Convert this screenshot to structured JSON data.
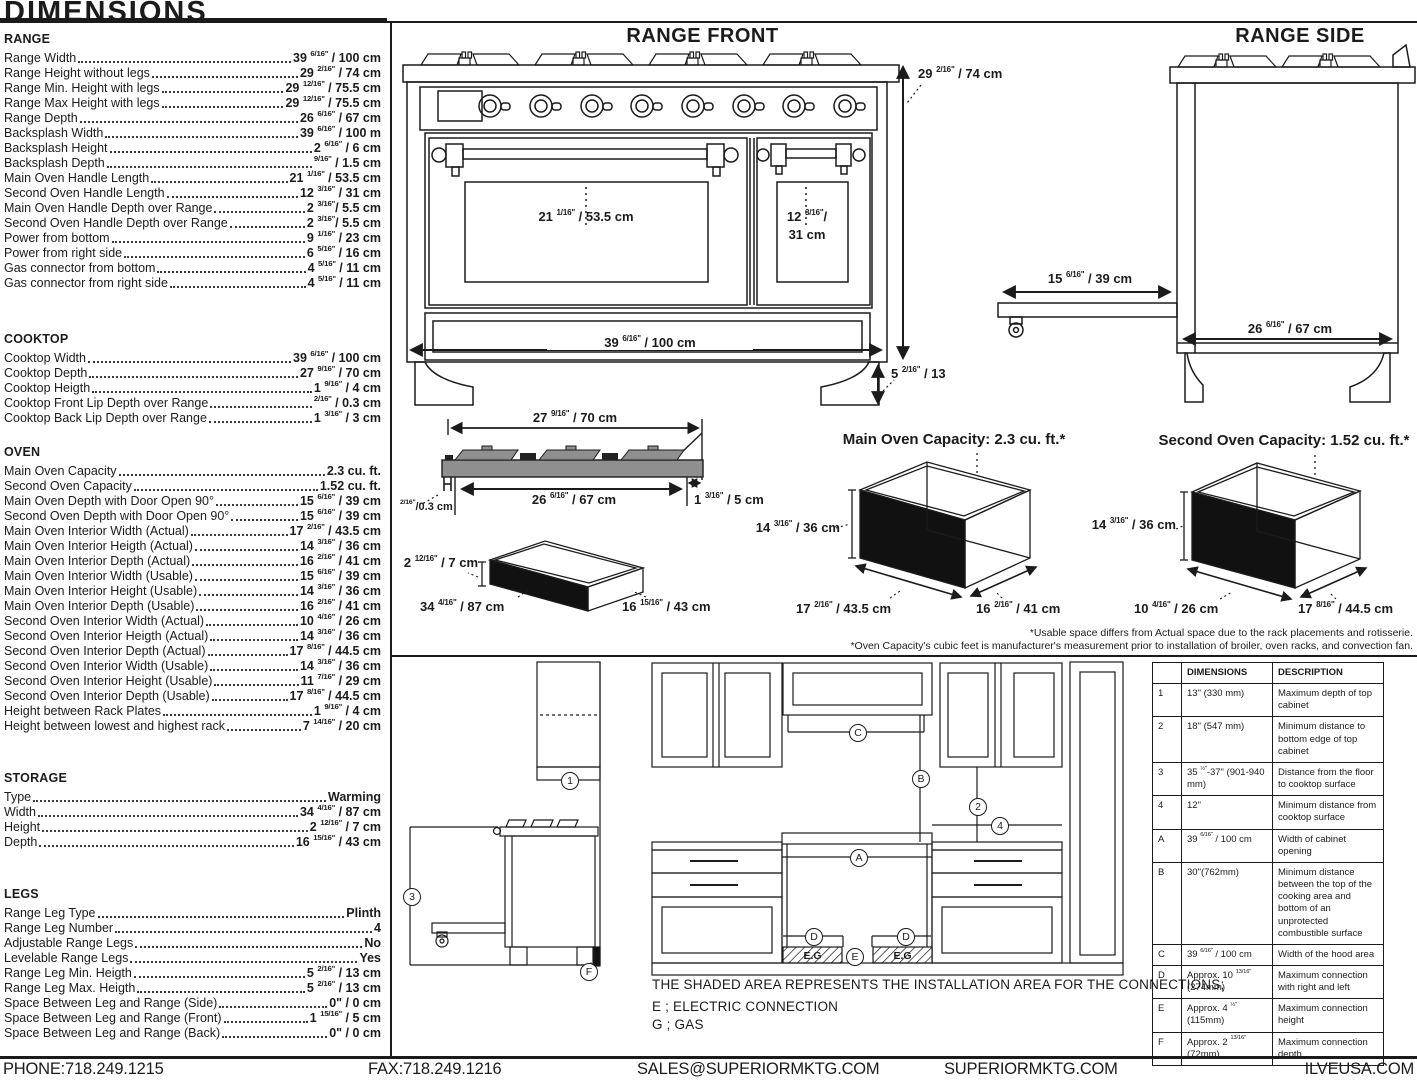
{
  "page": {
    "title": "DIMENSIONS",
    "footer": {
      "phone": "PHONE:718.249.1215",
      "fax": "FAX:718.249.1216",
      "email": "SALES@SUPERIORMKTG.COM",
      "website": "SUPERIORMKTG.COM",
      "brand_site": "ILVEUSA.COM"
    }
  },
  "specs": {
    "range": {
      "title": "RANGE",
      "rows": [
        {
          "label": "Range Width",
          "value": "39 6/16\" / 100 cm"
        },
        {
          "label": "Range Height without legs",
          "value": "29 2/16\" / 74 cm"
        },
        {
          "label": "Range Min. Height with legs",
          "value": "29 12/16\" / 75.5 cm"
        },
        {
          "label": "Range Max Height with legs",
          "value": "29 12/16\" / 75.5 cm"
        },
        {
          "label": "Range Depth",
          "value": "26 6/16\" / 67 cm"
        },
        {
          "label": "Backsplash Width",
          "value": "39 6/16\" / 100 m"
        },
        {
          "label": "Backsplash Height",
          "value": "2 6/16\" / 6 cm"
        },
        {
          "label": "Backsplash Depth",
          "value": "9/16\" / 1.5 cm"
        },
        {
          "label": "Main Oven Handle Length",
          "value": "21 1/16\" / 53.5 cm"
        },
        {
          "label": "Second Oven Handle Length",
          "value": "12 3/16\" / 31 cm"
        },
        {
          "label": "Main Oven Handle Depth over Range",
          "value": "2 3/16\"/ 5.5 cm"
        },
        {
          "label": "Second Oven Handle Depth over Range",
          "value": "2 3/16\"/ 5.5 cm"
        },
        {
          "label": "Power from bottom",
          "value": "9 1/16\" / 23 cm"
        },
        {
          "label": "Power from right side",
          "value": "6 5/16\" / 16 cm"
        },
        {
          "label": "Gas connector from bottom",
          "value": "4 5/16\" / 11 cm"
        },
        {
          "label": "Gas connector from right side",
          "value": "4 5/16\" / 11 cm"
        }
      ]
    },
    "cooktop": {
      "title": "COOKTOP",
      "rows": [
        {
          "label": "Cooktop Width",
          "value": "39 6/16\" / 100 cm"
        },
        {
          "label": "Cooktop Depth",
          "value": "27 9/16\" / 70 cm"
        },
        {
          "label": "Cooktop Heigth",
          "value": "1 9/16\" / 4 cm"
        },
        {
          "label": "Cooktop Front Lip Depth over Range",
          "value": "2/16\" / 0.3 cm"
        },
        {
          "label": "Cooktop Back Lip Depth over Range",
          "value": "1 3/16\" / 3 cm"
        }
      ]
    },
    "oven": {
      "title": "OVEN",
      "rows": [
        {
          "label": "Main Oven Capacity",
          "value": "2.3 cu. ft."
        },
        {
          "label": "Second Oven Capacity",
          "value": "1.52 cu. ft."
        },
        {
          "label": "Main Oven Depth with Door Open 90°",
          "value": "15 6/16\" / 39 cm"
        },
        {
          "label": "Second Oven Depth with Door Open 90°",
          "value": "15 6/16\" / 39 cm"
        },
        {
          "label": "Main Oven Interior Width (Actual)",
          "value": "17 2/16\" / 43.5 cm"
        },
        {
          "label": "Main Oven Interior Heigth (Actual)",
          "value": "14 3/16\" / 36 cm"
        },
        {
          "label": "Main Oven Interior Depth (Actual)",
          "value": "16 2/16\" / 41 cm"
        },
        {
          "label": "Main Oven Interior Width (Usable)",
          "value": "15 6/16\" / 39 cm"
        },
        {
          "label": "Main Oven Interior Height (Usable)",
          "value": "14 3/16\" / 36 cm"
        },
        {
          "label": "Main Oven Interior Depth (Usable)",
          "value": "16 2/16\" / 41 cm"
        },
        {
          "label": "Second Oven Interior Width (Actual)",
          "value": "10 4/16\" / 26 cm"
        },
        {
          "label": "Second Oven Interior Heigth (Actual)",
          "value": "14 3/16\" / 36 cm"
        },
        {
          "label": "Second Oven Interior Depth (Actual)",
          "value": "17 8/16\" / 44.5 cm"
        },
        {
          "label": "Second Oven Interior Width (Usable)",
          "value": "14 3/16\" / 36 cm"
        },
        {
          "label": "Second Oven Interior Height (Usable)",
          "value": "11 7/16\" / 29 cm"
        },
        {
          "label": "Second Oven Interior Depth (Usable)",
          "value": "17 8/16\" / 44.5 cm"
        },
        {
          "label": "Height between Rack Plates",
          "value": "1 9/16\" / 4 cm"
        },
        {
          "label": "Height between lowest and highest rack",
          "value": "7 14/16\" / 20 cm"
        }
      ]
    },
    "storage": {
      "title": "STORAGE",
      "rows": [
        {
          "label": "Type",
          "value": "Warming"
        },
        {
          "label": "Width",
          "value": "34 4/16\" / 87 cm"
        },
        {
          "label": "Height",
          "value": "2 12/16\" / 7 cm"
        },
        {
          "label": "Depth",
          "value": "16 15/16\" / 43 cm"
        }
      ]
    },
    "legs": {
      "title": "LEGS",
      "rows": [
        {
          "label": "Range Leg Type",
          "value": "Plinth"
        },
        {
          "label": "Range Leg Number",
          "value": "4"
        },
        {
          "label": "Adjustable Range Legs",
          "value": "No"
        },
        {
          "label": "Levelable Range Legs",
          "value": "Yes"
        },
        {
          "label": "Range Leg Min. Heigth",
          "value": "5 2/16\" / 13 cm"
        },
        {
          "label": "Range Leg Max. Heigth",
          "value": "5 2/16\" / 13 cm"
        },
        {
          "label": "Space Between Leg and Range (Side)",
          "value": "0\" / 0 cm"
        },
        {
          "label": "Space Between Leg and Range (Front)",
          "value": "1 15/16\" / 5 cm"
        },
        {
          "label": "Space Between Leg and Range (Back)",
          "value": "0\" / 0 cm"
        }
      ]
    }
  },
  "diagrams": {
    "range_front": {
      "title": "RANGE FRONT",
      "labels": {
        "height": "29 2/16\" / 74 cm",
        "main_handle": "21 1/16\" / 53.5 cm",
        "second_handle_line1": "12 3/16\"/",
        "second_handle_line2": "31 cm",
        "width": "39 6/16\" / 100 cm",
        "leg_height": "5 2/16\" / 13"
      }
    },
    "range_side": {
      "title": "RANGE SIDE",
      "labels": {
        "drawer_extension": "15 6/16\" / 39 cm",
        "depth": "26 6/16\" / 67 cm"
      }
    },
    "cooktop_profile": {
      "labels": {
        "top_width": "27 9/16\" / 70 cm",
        "bottom_width": "26 6/16\" / 67 cm",
        "back_lip": "1 3/16\" / 5 cm",
        "front_lip": "2/16\"/0.3 cm"
      }
    },
    "storage_drawer": {
      "labels": {
        "height": "2 12/16\" / 7 cm",
        "width": "34 4/16\" / 87 cm",
        "depth": "16 15/16\" / 43 cm"
      }
    },
    "main_oven": {
      "title": "Main Oven Capacity: 2.3 cu. ft.*",
      "labels": {
        "height": "14 3/16\" / 36 cm",
        "width": "17 2/16\" / 43.5 cm",
        "depth": "16 2/16\" / 41 cm"
      }
    },
    "second_oven": {
      "title": "Second Oven Capacity: 1.52 cu. ft.*",
      "labels": {
        "height": "14 3/16\" / 36 cm",
        "width": "10 4/16\" / 26 cm",
        "depth": "17 8/16\" / 44.5 cm"
      }
    },
    "footnote1": "*Usable space differs from Actual space due to the rack placements and rotisserie.",
    "footnote2": "*Oven Capacity's cubic feet is manufacturer's measurement prior to installation of broiler, oven racks, and convection fan."
  },
  "installation": {
    "note": "THE SHADED AREA REPRESENTS THE INSTALLATION AREA FOR THE CONNECTIONS;",
    "electric": "E ; ELECTRIC CONNECTION",
    "gas": "G ; GAS",
    "shaded_label": "E.G",
    "markers": {
      "n1": "1",
      "n2": "2",
      "n3": "3",
      "n4": "4",
      "a": "A",
      "b": "B",
      "c": "C",
      "d": "D",
      "e": "E",
      "f": "F"
    }
  },
  "table": {
    "headers": {
      "dimensions": "DIMENSIONS",
      "description": "DESCRIPTION"
    },
    "rows": [
      {
        "id": "1",
        "dim": "13\" (330 mm)",
        "desc": "Maximum depth of top cabinet"
      },
      {
        "id": "2",
        "dim": "18\" (547 mm)",
        "desc": "Minimum distance to bottom edge of top cabinet"
      },
      {
        "id": "3",
        "dim": "35 ½\"-37\" (901-940 mm)",
        "desc": "Distance from the floor to cooktop surface"
      },
      {
        "id": "4",
        "dim": "12\"",
        "desc": "Minimum distance from cooktop surface"
      },
      {
        "id": "A",
        "dim": "39 6/16\" / 100 cm",
        "desc": "Width of cabinet opening"
      },
      {
        "id": "B",
        "dim": "30\"(762mm)",
        "desc": "Minimum distance between the top of the cooking area and bottom of an unprotected combustible surface"
      },
      {
        "id": "C",
        "dim": "39 6/16\" / 100 cm",
        "desc": "Width of the hood area"
      },
      {
        "id": "D",
        "dim": "Approx. 10 13/16\" (274mm)",
        "desc": "Maximum connection with right and left"
      },
      {
        "id": "E",
        "dim": "Approx. 4 ½\" (115mm)",
        "desc": "Maximum connection height"
      },
      {
        "id": "F",
        "dim": "Approx. 2 13/16\" (72mm)",
        "desc": "Maximum connection depth"
      }
    ]
  }
}
